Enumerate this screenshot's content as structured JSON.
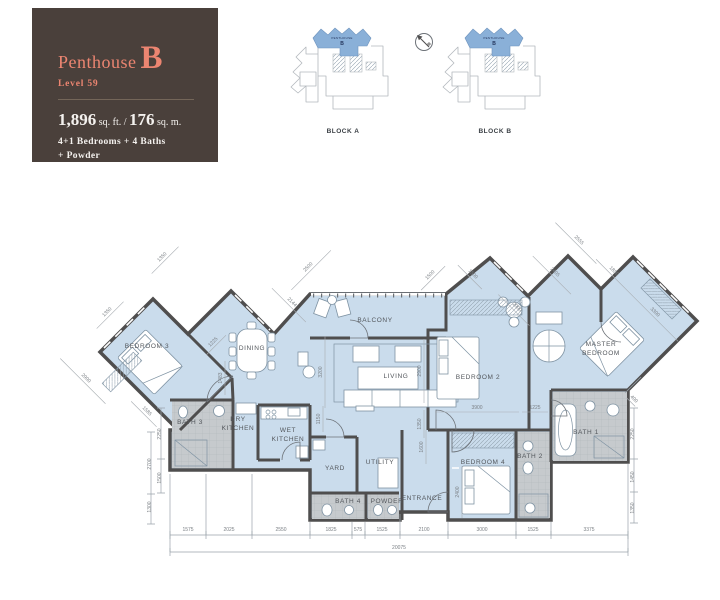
{
  "info_panel": {
    "name": "Penthouse",
    "unit": "B",
    "level": "Level 59",
    "area_ft": "1,896",
    "area_ft_unit": "sq. ft. /",
    "area_m": "176",
    "area_m_unit": "sq. m.",
    "config_line1": "4+1 Bedrooms + 4 Baths",
    "config_line2": "+ Powder"
  },
  "colors": {
    "panel_bg": "#4a403b",
    "accent_salmon": "#ec8571",
    "floor_blue": "#cadcec",
    "bath_gray": "#c6cacd",
    "wall": "#4f4e4e",
    "site_highlight": "#8ab0d8"
  },
  "site_plans": {
    "block_a_label": "BLOCK A",
    "block_b_label": "BLOCK B",
    "unit_tag_line1": "PENTHOUSE",
    "unit_tag_line2": "B"
  },
  "floor_plan": {
    "rooms": [
      {
        "t": "BEDROOM 3",
        "x": 147,
        "y": 348
      },
      {
        "t": "DINING",
        "x": 252,
        "y": 350
      },
      {
        "t": "BALCONY",
        "x": 375,
        "y": 322
      },
      {
        "t": "LIVING",
        "x": 396,
        "y": 378
      },
      {
        "t": "BEDROOM 2",
        "x": 478,
        "y": 379
      },
      {
        "t": "MASTER",
        "x": 601,
        "y": 346
      },
      {
        "t": "BEDROOM",
        "x": 601,
        "y": 355
      },
      {
        "t": "BATH 3",
        "x": 190,
        "y": 424
      },
      {
        "t": "DRY",
        "x": 238,
        "y": 421
      },
      {
        "t": "KITCHEN",
        "x": 238,
        "y": 430
      },
      {
        "t": "WET",
        "x": 288,
        "y": 432
      },
      {
        "t": "KITCHEN",
        "x": 288,
        "y": 441
      },
      {
        "t": "YARD",
        "x": 335,
        "y": 470
      },
      {
        "t": "UTILITY",
        "x": 380,
        "y": 464
      },
      {
        "t": "BEDROOM 4",
        "x": 483,
        "y": 464
      },
      {
        "t": "BATH 2",
        "x": 530,
        "y": 458
      },
      {
        "t": "BATH 1",
        "x": 586,
        "y": 434
      },
      {
        "t": "BATH 4",
        "x": 348,
        "y": 503
      },
      {
        "t": "POWDER",
        "x": 387,
        "y": 503
      },
      {
        "t": "ENTRANCE",
        "x": 422,
        "y": 500
      }
    ],
    "dims": [
      {
        "t": "1350",
        "x": 108,
        "y": 313,
        "r": -45,
        "l": 38
      },
      {
        "t": "1350",
        "x": 163,
        "y": 258,
        "r": -45,
        "l": 38
      },
      {
        "t": "2500",
        "x": 309,
        "y": 268,
        "r": -45,
        "l": 56
      },
      {
        "t": "2144",
        "x": 291,
        "y": 303,
        "r": 45,
        "l": 48
      },
      {
        "t": "1500",
        "x": 431,
        "y": 276,
        "r": -45,
        "l": 34
      },
      {
        "t": "1500",
        "x": 472,
        "y": 275,
        "r": 45,
        "l": 34
      },
      {
        "t": "2000",
        "x": 516,
        "y": 308,
        "r": 45,
        "l": 44
      },
      {
        "t": "2405",
        "x": 554,
        "y": 273,
        "r": 45,
        "l": 54
      },
      {
        "t": "2555",
        "x": 578,
        "y": 241,
        "r": 45,
        "l": 58
      },
      {
        "t": "1850",
        "x": 613,
        "y": 272,
        "r": 45,
        "l": 42
      },
      {
        "t": "3300",
        "x": 654,
        "y": 313,
        "r": 45,
        "l": 74
      },
      {
        "t": "2900",
        "x": 85,
        "y": 379,
        "r": 45,
        "l": 64
      },
      {
        "t": "1585",
        "x": 146,
        "y": 412,
        "r": 45,
        "l": 36
      },
      {
        "t": "1225",
        "x": 214,
        "y": 343,
        "r": -45,
        "l": 28
      },
      {
        "t": "1483",
        "x": 222,
        "y": 378,
        "r": -90,
        "l": 34
      },
      {
        "t": "2250",
        "x": 161,
        "y": 434,
        "r": -90,
        "nl": true
      },
      {
        "t": "2700",
        "x": 151,
        "y": 464,
        "r": -90,
        "nl": true
      },
      {
        "t": "1500",
        "x": 161,
        "y": 478,
        "r": -90,
        "nl": true
      },
      {
        "t": "1300",
        "x": 151,
        "y": 507,
        "r": -90,
        "nl": true
      },
      {
        "t": "3200",
        "x": 322,
        "y": 372,
        "r": -90,
        "l": 72
      },
      {
        "t": "1150",
        "x": 320,
        "y": 419,
        "r": -90,
        "l": 26
      },
      {
        "t": "2900",
        "x": 421,
        "y": 371,
        "r": -90,
        "l": 64
      },
      {
        "t": "1350",
        "x": 421,
        "y": 424,
        "r": -90,
        "l": 28
      },
      {
        "t": "1600",
        "x": 423,
        "y": 447,
        "r": -90,
        "l": 34
      },
      {
        "t": "3900",
        "x": 477,
        "y": 409,
        "r": 0,
        "l": 84
      },
      {
        "t": "1225",
        "x": 535,
        "y": 409,
        "r": 0,
        "l": 26
      },
      {
        "t": "2400",
        "x": 459,
        "y": 492,
        "r": -90,
        "l": 52
      },
      {
        "t": "400",
        "x": 633,
        "y": 400,
        "r": 45,
        "l": 12
      },
      {
        "t": "2250",
        "x": 634,
        "y": 434,
        "r": -90,
        "nl": true
      },
      {
        "t": "1450",
        "x": 634,
        "y": 477,
        "r": -90,
        "nl": true
      },
      {
        "t": "1350",
        "x": 634,
        "y": 508,
        "r": -90,
        "nl": true
      },
      {
        "t": "1575",
        "x": 188,
        "y": 531,
        "r": 0,
        "nl": true
      },
      {
        "t": "2025",
        "x": 229,
        "y": 531,
        "r": 0,
        "nl": true
      },
      {
        "t": "2550",
        "x": 281,
        "y": 531,
        "r": 0,
        "nl": true
      },
      {
        "t": "1825",
        "x": 331,
        "y": 531,
        "r": 0,
        "nl": true
      },
      {
        "t": "575",
        "x": 358,
        "y": 531,
        "r": 0,
        "nl": true
      },
      {
        "t": "1525",
        "x": 382,
        "y": 531,
        "r": 0,
        "nl": true
      },
      {
        "t": "2100",
        "x": 424,
        "y": 531,
        "r": 0,
        "nl": true
      },
      {
        "t": "3000",
        "x": 482,
        "y": 531,
        "r": 0,
        "nl": true
      },
      {
        "t": "1525",
        "x": 533,
        "y": 531,
        "r": 0,
        "nl": true
      },
      {
        "t": "3375",
        "x": 589,
        "y": 531,
        "r": 0,
        "nl": true
      },
      {
        "t": "20075",
        "x": 399,
        "y": 549,
        "r": 0,
        "nl": true
      }
    ]
  }
}
